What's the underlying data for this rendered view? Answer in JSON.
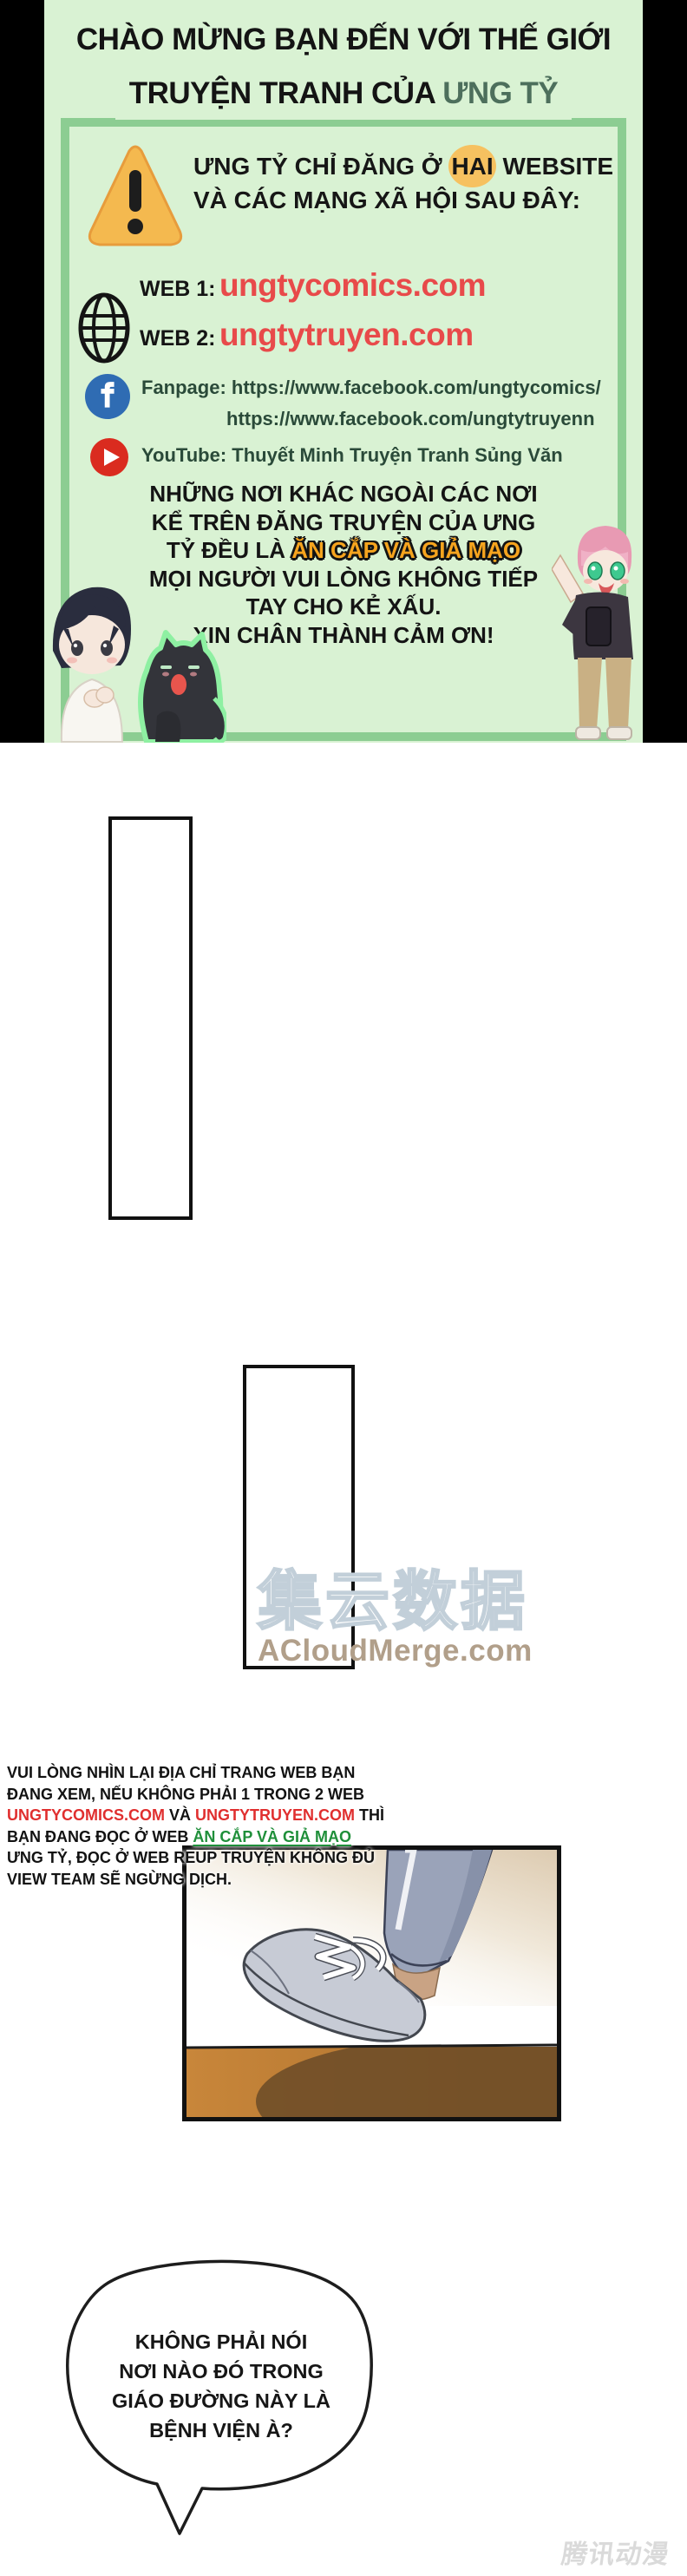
{
  "header": {
    "title_line1": "CHÀO MỪNG BẠN ĐẾN VỚI THẾ GIỚI",
    "title_line2_prefix": "TRUYỆN TRANH CỦA ",
    "title_line2_accent": "ƯNG TỶ",
    "warning": {
      "line1_pre": "ƯNG TỶ CHỈ ĐĂNG Ở ",
      "line1_highlight": "HAI",
      "line1_post": " WEBSITE",
      "line2": "VÀ CÁC MẠNG XÃ HỘI SAU ĐÂY:"
    },
    "websites": [
      {
        "label": "WEB 1:",
        "url": "ungtycomics.com"
      },
      {
        "label": "WEB 2:",
        "url": "ungtytruyen.com"
      }
    ],
    "fanpage_label": "Fanpage:",
    "fanpage_url1": "https://www.facebook.com/ungtycomics/",
    "fanpage_url2": "https://www.facebook.com/ungtytruyenn",
    "youtube_label": "YouTube:",
    "youtube_channel": "Thuyết Minh Truyện Tranh Sủng Văn",
    "notice": {
      "line1": "NHỮNG NƠI KHÁC NGOÀI CÁC NƠI",
      "line2": "KỂ TRÊN ĐĂNG TRUYỆN CỦA ƯNG",
      "line3_pre": "TỶ ĐỀU LÀ ",
      "line3_accent": "ĂN CẮP VÀ GIẢ MẠO",
      "line4": "MỌI NGƯỜI VUI LÒNG KHÔNG TIẾP",
      "line5": "TAY CHO KẺ XẤU.",
      "line6": "XIN CHÂN THÀNH CẢM ƠN!"
    }
  },
  "watermark_center": {
    "cjk": "集云数据",
    "site": "ACloudMerge.com"
  },
  "notice_block": {
    "line1": "VUI LÒNG NHÌN LẠI ĐỊA CHỈ TRANG WEB BẠN",
    "line2": "ĐANG XEM, NẾU KHÔNG PHẢI 1 TRONG 2 WEB",
    "line3_url1": "UNGTYCOMICS.COM",
    "line3_mid": " VÀ ",
    "line3_url2": "UNGTYTRUYEN.COM",
    "line3_post": " THÌ",
    "line4_pre": "BẠN ĐANG ĐỌC Ở WEB ",
    "line4_accent": "ĂN CẮP VÀ GIẢ MẠO",
    "line5": "ƯNG TỶ, ĐỌC Ở WEB REUP TRUYỆN KHÔNG ĐỦ",
    "line6": "VIEW TEAM SẼ NGỪNG DỊCH."
  },
  "speech_bubble": {
    "line1": "KHÔNG PHẢI NÓI",
    "line2": "NƠI NÀO ĐÓ TRONG",
    "line3": "GIÁO ĐƯỜNG NÀY LÀ",
    "line4": "BỆNH VIỆN À?"
  },
  "watermark_corner": "腾讯动漫",
  "colors": {
    "header_bg": "#d9f2d3",
    "box_border": "#8ccd92",
    "title_accent": "#4d6f5c",
    "url_red": "#e84a4a",
    "sns_green": "#2a4a39",
    "accent_orange": "#f6a41e",
    "notice_red": "#e02f2f",
    "notice_green": "#1f8f3a",
    "floor_brown": "#bc7c31"
  }
}
